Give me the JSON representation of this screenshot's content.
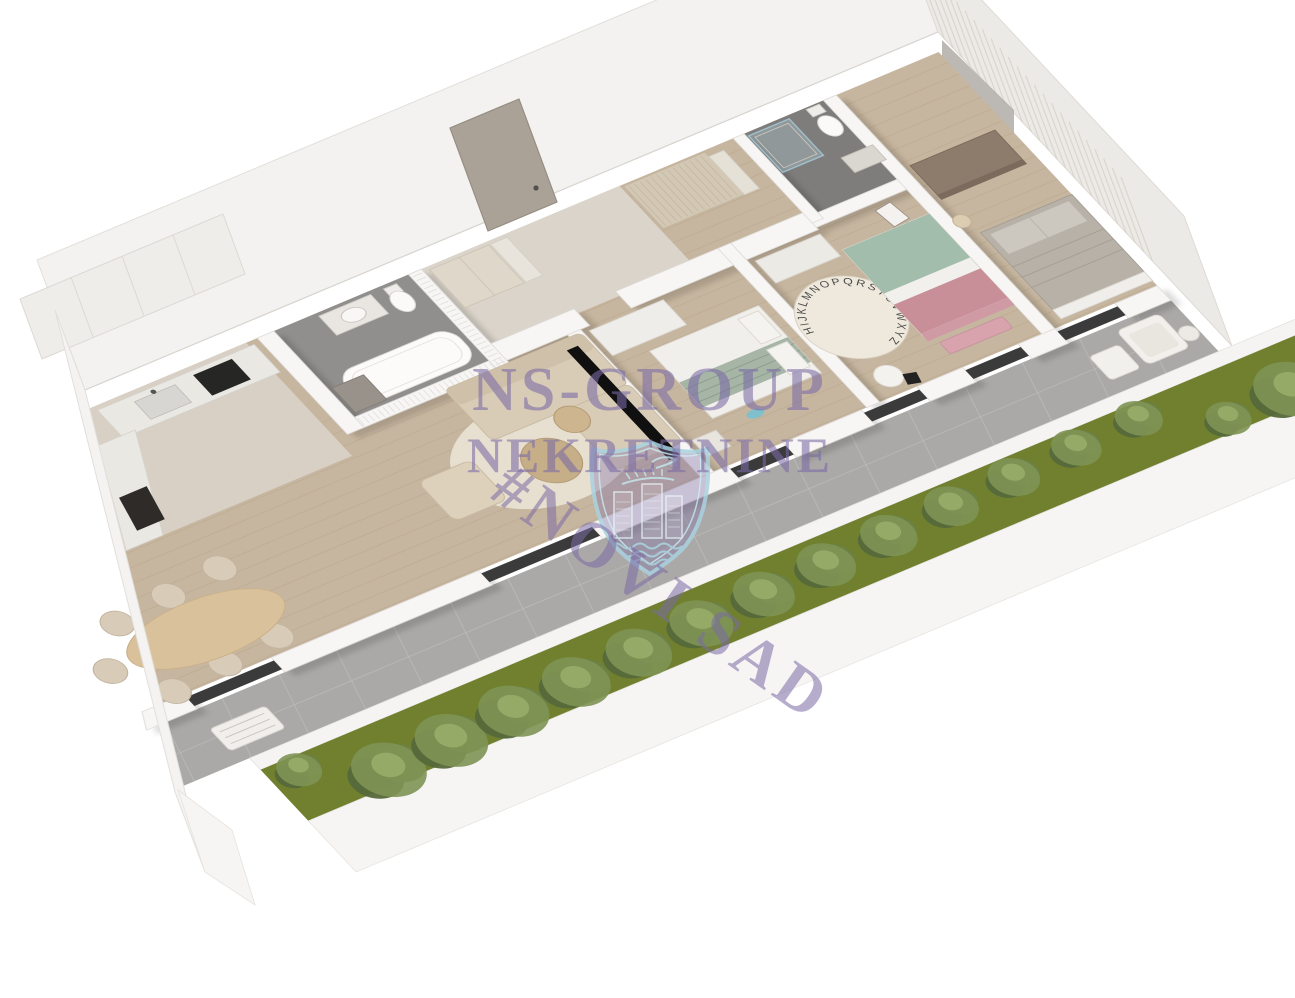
{
  "image": {
    "type": "3d-floor-plan-render",
    "background": "#ffffff"
  },
  "watermark": {
    "line1": "NS-GROUP",
    "line2": "NEKRETNINE",
    "line3": "#NOVI SAD",
    "text_color": "#7b6ba6",
    "logo": {
      "name": "novi-sad-shield",
      "outline_color": "#a9d2e0",
      "fill_color": "#877aab",
      "motifs": [
        "dove-with-olive-branch",
        "three-towers",
        "river-waves"
      ]
    }
  },
  "rug": {
    "letters": "HIJKLMNOPQRSTUVWXYZ"
  },
  "palette": {
    "wall": "#f6f5f3",
    "wood_floor": "#c7b69f",
    "stone_floor": "#d8d0c5",
    "bathroom_floor": "#908f8d",
    "terrace_tile": "#aaa9a7",
    "grass": "#70802f",
    "hedge": "#5b6e3a",
    "watermark": "#7b6ba6",
    "bed_pink": "#c98f99",
    "bed_green": "#a3bdac",
    "tv_black": "#101010"
  },
  "rooms": [
    {
      "name": "kitchen",
      "features": [
        "upper-cabinets",
        "counter-with-sink",
        "cooktop",
        "oven-column"
      ]
    },
    {
      "name": "dining-area",
      "features": [
        "oval-dining-table",
        "seven-chairs"
      ]
    },
    {
      "name": "living-room",
      "features": [
        "corner-sofa",
        "armchair",
        "two-round-coffee-tables",
        "wall-mounted-tv",
        "round-rug"
      ]
    },
    {
      "name": "bathroom",
      "features": [
        "bathtub",
        "toilet",
        "vanity-with-round-mirror",
        "laundry-cabinet",
        "ribbed-partition-wall"
      ]
    },
    {
      "name": "hallway",
      "features": [
        "entrance-door",
        "two-wardrobes",
        "open-shelving"
      ]
    },
    {
      "name": "bedroom-1",
      "features": [
        "double-bed",
        "wardrobe",
        "nightstand",
        "plush-whale-toy"
      ]
    },
    {
      "name": "bedroom-2-kids",
      "features": [
        "bed-with-pink-and-green-bedding",
        "alphabet-rug",
        "easel",
        "dresser",
        "desk-with-chair",
        "bench"
      ]
    },
    {
      "name": "master-bedroom",
      "features": [
        "double-bed",
        "brown-dresser",
        "floor-lamp",
        "striped-accent-wall"
      ]
    },
    {
      "name": "en-suite-bathroom",
      "features": [
        "glass-shower",
        "toilet",
        "vanity-with-round-mirror",
        "concrete-accent-panel"
      ]
    },
    {
      "name": "terrace",
      "features": [
        "tiled-floor",
        "garden-bench",
        "lounge-armchair-with-ottomans",
        "planter-with-hedge",
        "lawn-strip"
      ]
    }
  ]
}
